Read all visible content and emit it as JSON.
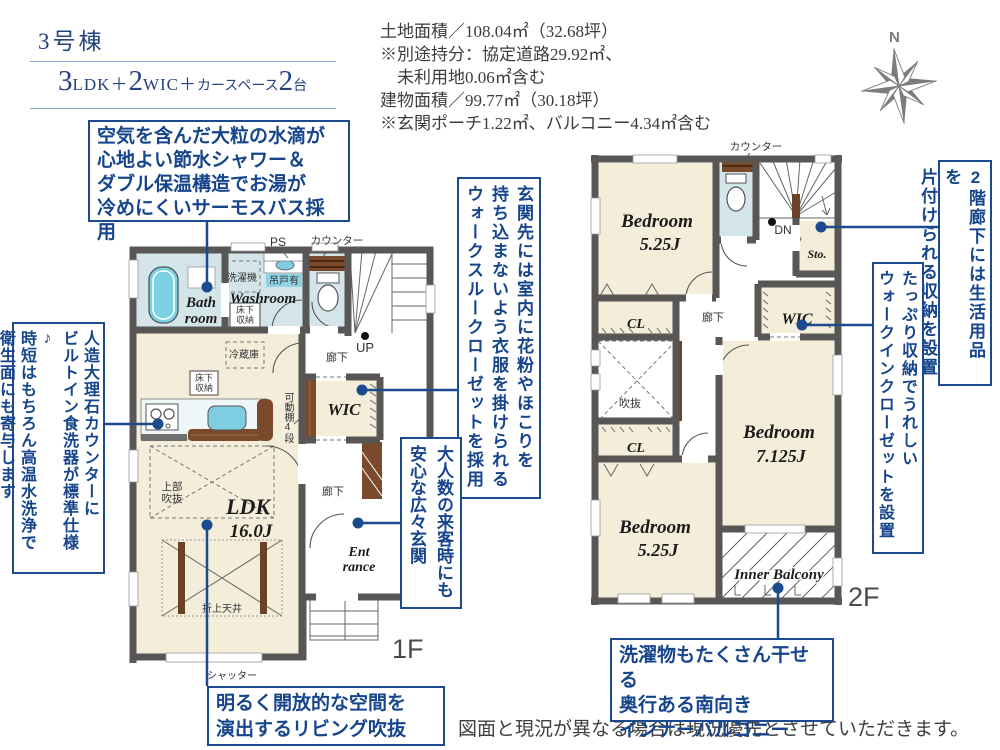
{
  "header": {
    "building_no": "3号棟",
    "plan": {
      "n1": "3",
      "t1": "LDK",
      "p1": "＋",
      "n2": "2",
      "t2": "WIC",
      "p2": "＋",
      "t3": "カースペース",
      "n3": "2",
      "t4": "台"
    }
  },
  "site_info": {
    "l1": "土地面積／108.04㎡（32.68坪）",
    "l2": "※別途持分：協定道路29.92㎡、",
    "l3": "　未利用地0.06㎡含む",
    "l4": "建物面積／99.77㎡（30.18坪）",
    "l5": "※玄関ポーチ1.22㎡、バルコニー4.34㎡含む"
  },
  "compass": {
    "north": "N"
  },
  "annotations": {
    "bath": {
      "l1": "空気を含んだ大粒の水滴が",
      "l2": "心地よい節水シャワー＆",
      "l3": "ダブル保温構造でお湯が",
      "l4": "冷めにくいサーモスバス採用"
    },
    "kitchen": {
      "c1": "人造大理石カウンターに",
      "c2": "ビルトイン食洗器が標準仕様♪",
      "c3": "時短はもちろん高温水洗浄で",
      "c4": "衛生面にも寄与します"
    },
    "walkthrough_closet": {
      "c1": "玄関先には室内に花粉やほこりを",
      "c2": "持ち込まないよう衣服を掛けられる",
      "c3": "ウォークスルークローゼットを採用"
    },
    "entrance": {
      "c1": "大人数の来客時にも",
      "c2": "安心な広々玄関"
    },
    "living_void": {
      "l1": "明るく開放的な空間を",
      "l2": "演出するリビング吹抜"
    },
    "hall_storage_2f": {
      "c1": "2階廊下には生活用品を",
      "c2": "片付けられる収納を設置"
    },
    "wic_2f": {
      "c1": "たっぷり収納でうれしい",
      "c2": "ウォークインクローゼットを設置"
    },
    "inner_balcony": {
      "l1": "洗濯物もたくさん干せる",
      "l2": "奥行ある南向き",
      "l3": "インナーバルコニー"
    }
  },
  "floor1": {
    "floor_label": "1F",
    "rooms": {
      "bath_l1": "Bath",
      "bath_l2": "room",
      "washroom": "Washroom",
      "wic": "WIC",
      "ldk": "LDK",
      "ldk_size": "16.0J",
      "ent_l1": "Ent",
      "ent_l2": "rance"
    },
    "labels": {
      "ps": "PS",
      "counter": "カウンター",
      "washer": "洗濯機",
      "hanging_cupboard": "吊戸有",
      "underfloor_l1": "床下",
      "underfloor_l2": "収納",
      "fridge": "冷蔵庫",
      "movable_shelf": "可動棚4段",
      "up": "UP",
      "hallway_upper": "廊下",
      "hallway_lower": "廊下",
      "void_l1": "上部",
      "void_l2": "吹抜",
      "coffered_ceiling": "折上天井",
      "shutter": "シャッター"
    }
  },
  "floor2": {
    "floor_label": "2F",
    "rooms": {
      "bedroom": "Bedroom",
      "bedroom1_size": "5.25J",
      "bedroom2_size": "7.125J",
      "bedroom3_size": "5.25J",
      "wic": "WIC",
      "storage": "Sto.",
      "closet": "CL",
      "inner_balcony": "Inner Balcony"
    },
    "labels": {
      "counter": "カウンター",
      "dn": "DN",
      "hallway": "廊下",
      "void": "吹抜"
    }
  },
  "footer": {
    "disclaimer": "図面と現況が異なる場合は現況優先とさせていただきます。"
  },
  "colors": {
    "accent_navy": "#1b4a8f",
    "wall_gray": "#595656",
    "tatami_cream": "#f3edd9",
    "wet_blue": "#d4e5ea",
    "wood_brown": "#7b4a2d",
    "tub_blue": "#7bd0e2",
    "compass_gray": "#7c7c7c"
  }
}
